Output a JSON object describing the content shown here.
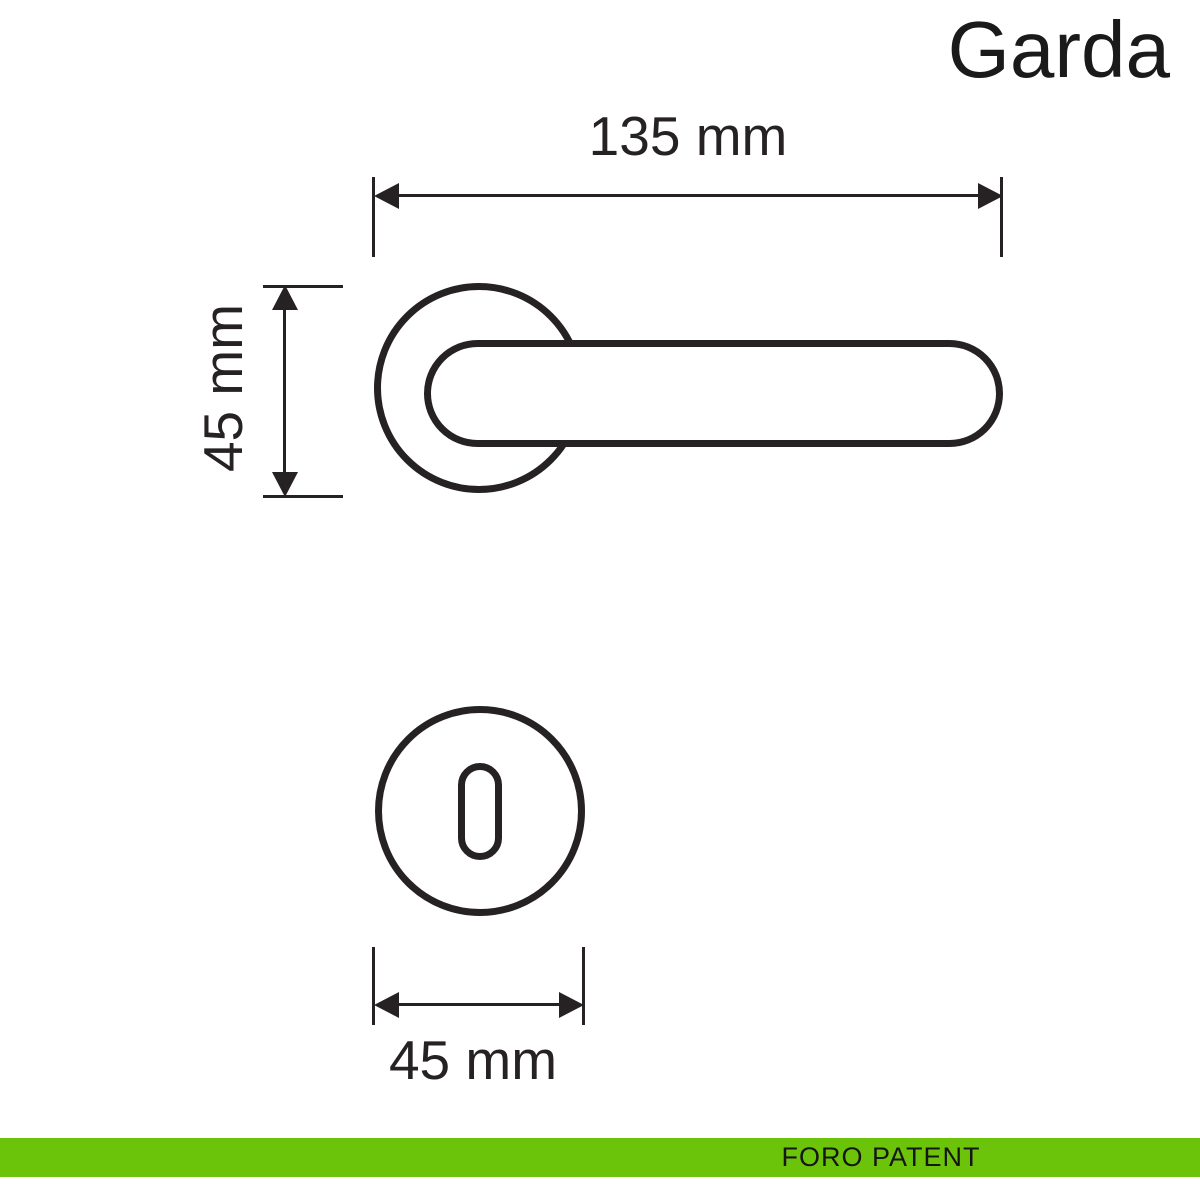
{
  "title": "Garda",
  "drawing": {
    "handle_length_label": "135 mm",
    "rosette_diameter_label": "45 mm",
    "escutcheon_diameter_label": "45 mm"
  },
  "footer": {
    "label": "FORO PATENT"
  },
  "colors": {
    "accent_green": "#6cc40a",
    "line": "#262223",
    "background": "#ffffff"
  }
}
